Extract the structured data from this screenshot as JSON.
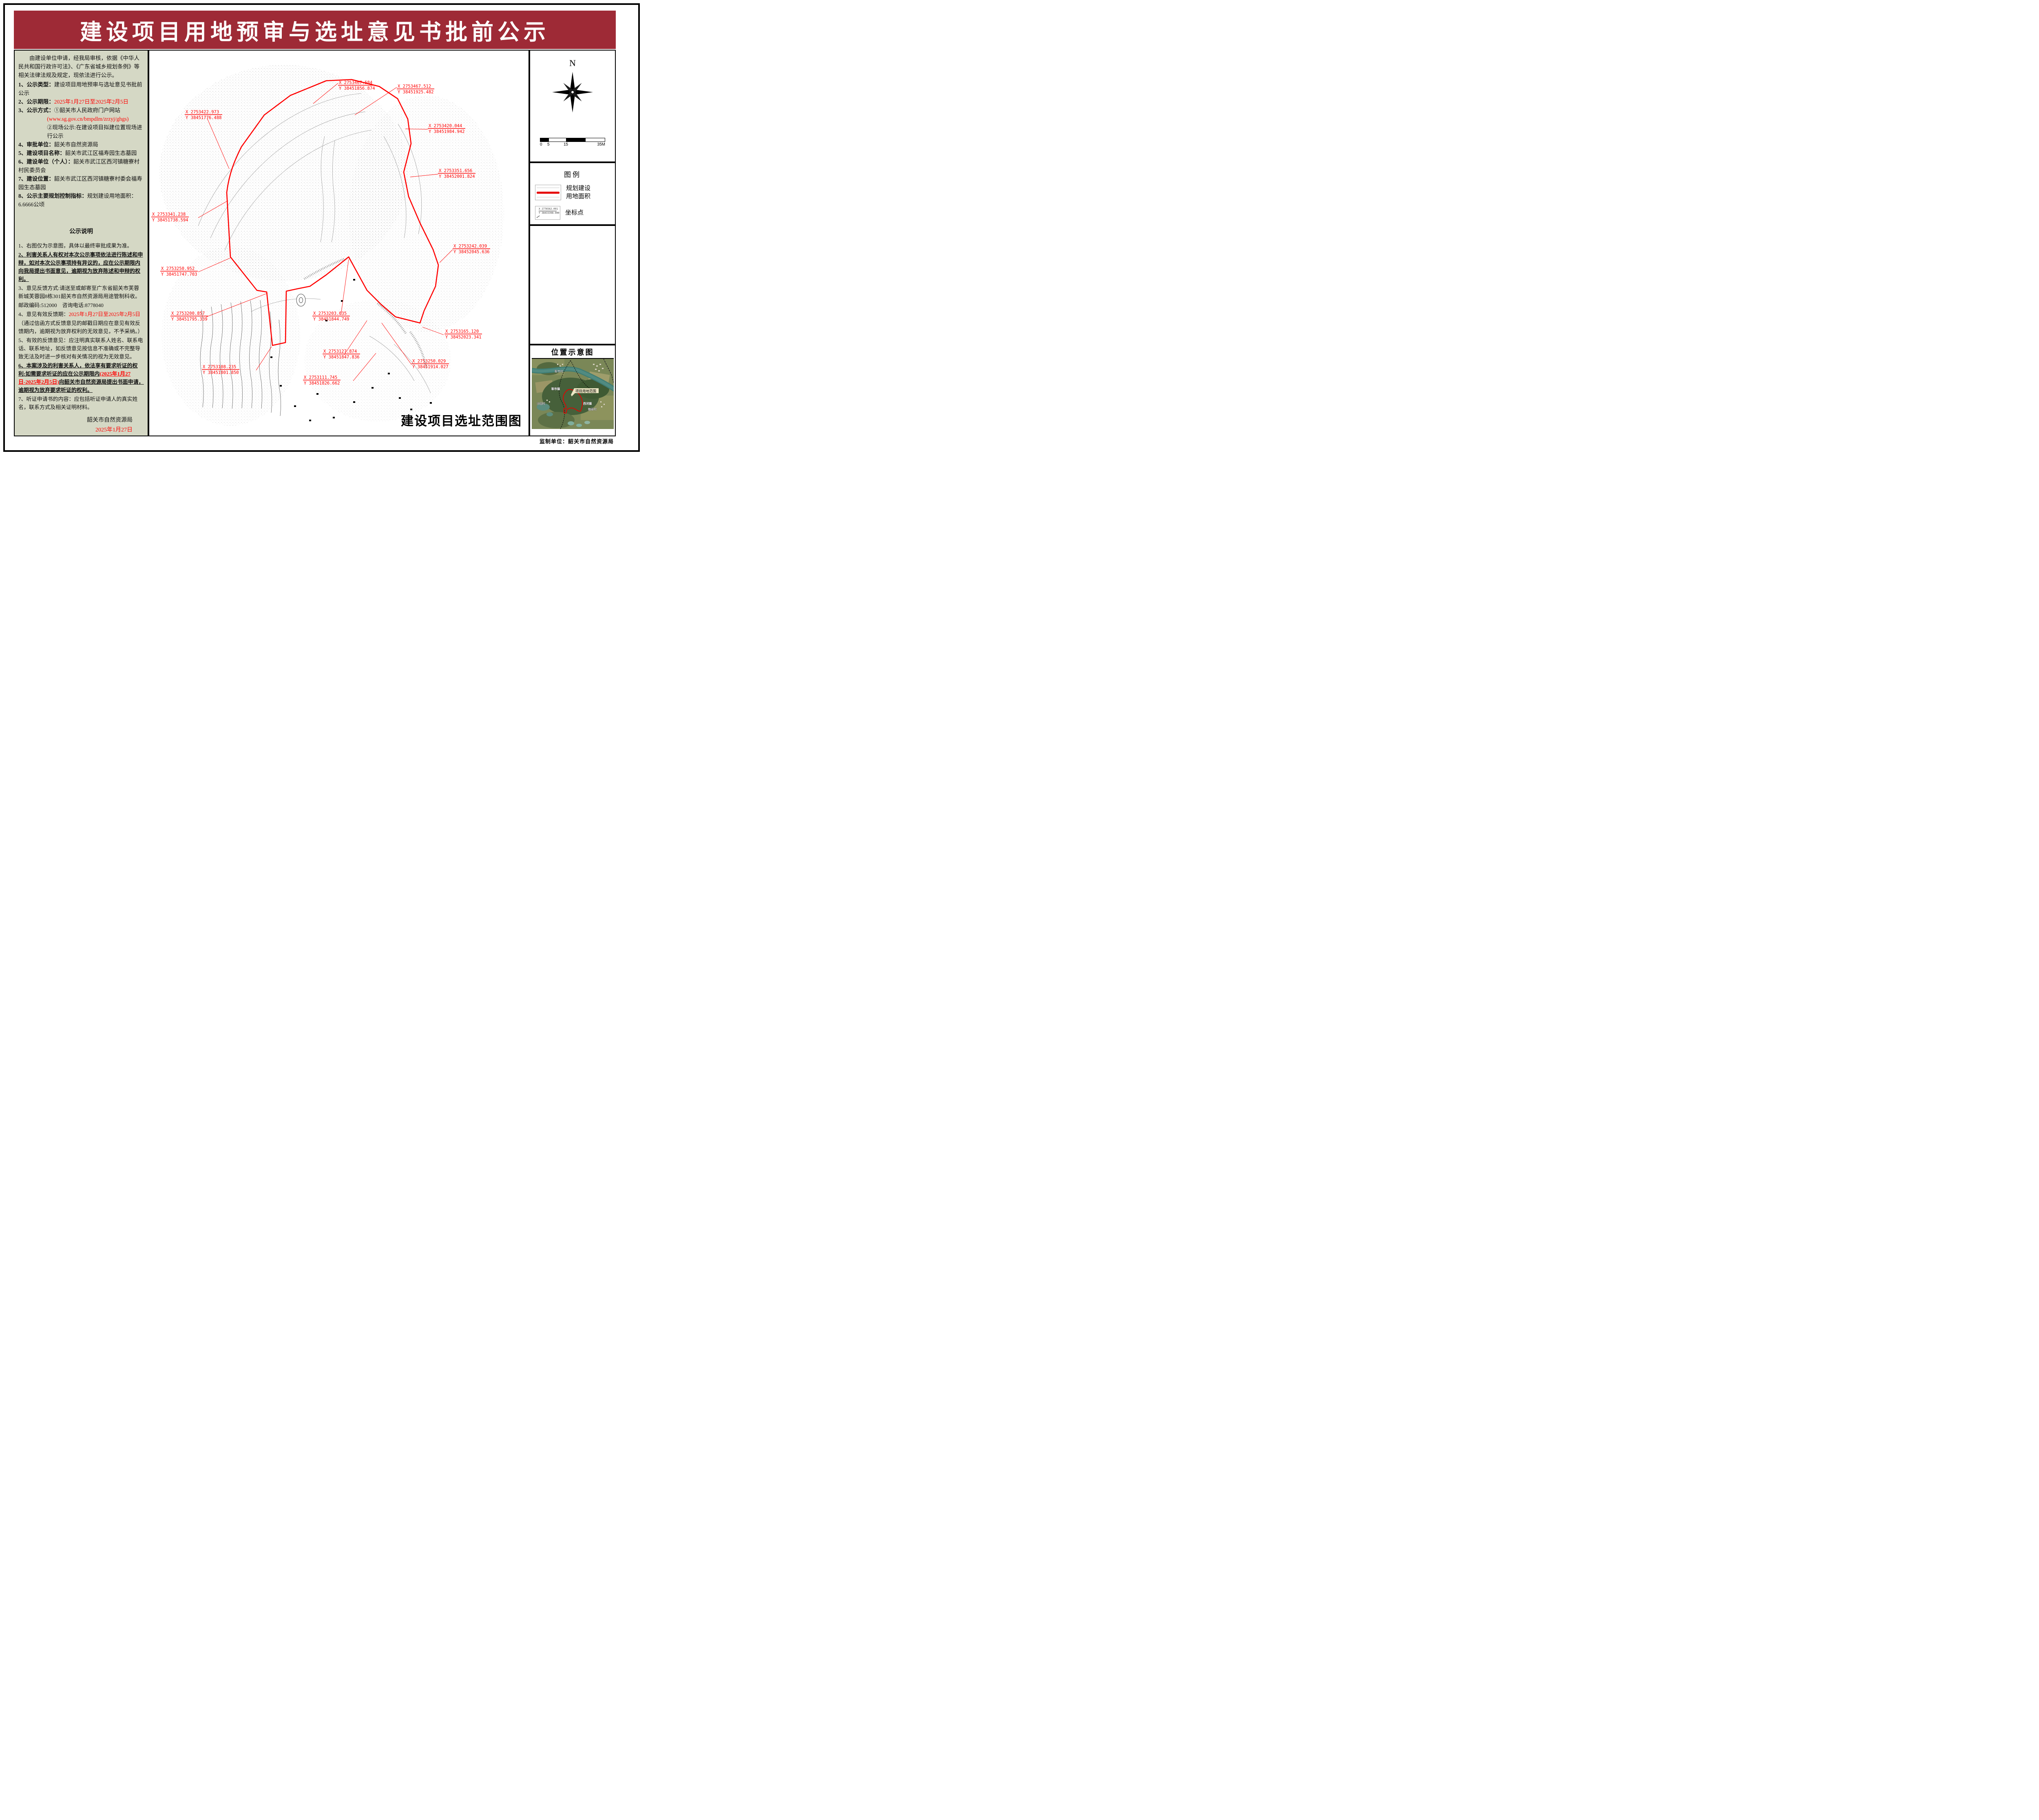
{
  "page": {
    "title": "建设项目用地预审与选址意见书批前公示",
    "colors": {
      "banner": "#9e2a36",
      "panel_bg": "#d5d8c5",
      "highlight_red": "#ff0000",
      "boundary_red": "#e60000"
    }
  },
  "left_panel": {
    "intro": "由建设单位申请，经我局审核，依据《中华人民共和国行政许可法》、《广东省城乡规划条例》等相关法律法规及规定，现依法进行公示。",
    "item1_label": "1、公示类型：",
    "item1_value": "建设项目用地预审与选址意见书批前公示",
    "item2_label": "2、公示期限：",
    "item2_value": "2025年1月27日至2025年2月5日",
    "item3_label": "3、公示方式：",
    "item3_value": "①韶关市人民政府门户网站",
    "item3_url": "(www.sg.gov.cn/bmpdlm/zrzyj/ghgs)",
    "item3_sub2": "②现场公示:在建设项目拟建位置现场进行公示",
    "item4_label": "4、审批单位：",
    "item4_value": "韶关市自然资源局",
    "item5_label": "5、建设项目名称：",
    "item5_value": "韶关市武江区福寿园生态墓园",
    "item6_label": "6、建设单位（个人）：",
    "item6_value": "韶关市武江区西河镇糖寮村村民委员会",
    "item7_label": "7、建设位置：",
    "item7_value": "韶关市武江区西河镇糖寮村委会福寿园生态墓园",
    "item8_label": "8、公示主要规划控制指标：",
    "item8_value": "规划建设用地面积：6.6666公顷",
    "notes_title": "公示说明",
    "note1": "1、右图仅为示意图，具体以最终审批成果为准。",
    "note2": "2、利害关系人有权对本次公示事项依法进行陈述和申辩，如对本次公示事项持有异议的，应在公示期限内向我局提出书面意见，逾期视为放弃陈述和申辩的权利。",
    "note3": "3、意见反馈方式:请送至或邮寄至广东省韶关市芙蓉新城芙蓉园8栋301韶关市自然资源局用途管制科收。",
    "note3b": "邮政编码:512000　咨询电话:8778040",
    "note4_label": "4、意见有效反馈期：",
    "note4_value": "2025年1月27日至2025年2月5日",
    "note4b": "（通过信函方式反馈意见的邮戳日期应在意见有效反馈期内，逾期视为放弃权利的无效意见，不予采纳。）",
    "note5": "5、有效的反馈意见：应注明真实联系人姓名、联系电话、联系地址，如反馈意见按信息不准确或不完整导致无法及时进一步核对有关情况的视为无效意见。",
    "note6_pre": "6、本案涉及的利害关系人，依法享有要求听证的权利:如需要求听证的应在公示期限内",
    "note6_red": "(2025年1月27日-2025年2月5日)",
    "note6_post": "向韶关市自然资源局提出书面申请，逾期视为放弃要求听证的权利。",
    "note7": "7、听证申请书的内容：应包括听证申请人的真实姓名，联系方式及相关证明材料。",
    "signature_org": "韶关市自然资源局",
    "signature_date": "2025年1月27日"
  },
  "map": {
    "title": "建设项目选址范围图",
    "labels": [
      {
        "x": "X 2753467.584",
        "y": "Y 38451856.874"
      },
      {
        "x": "X 2753467.512",
        "y": "Y 38451925.482"
      },
      {
        "x": "X 2753422.973",
        "y": "Y 38451776.488"
      },
      {
        "x": "X 2753420.044",
        "y": "Y 38451984.942"
      },
      {
        "x": "X 2753351.656",
        "y": "Y 38452001.824"
      },
      {
        "x": "X 2753341.238",
        "y": "Y 38451738.594"
      },
      {
        "x": "X 2753242.039",
        "y": "Y 38452045.636"
      },
      {
        "x": "X 2753250.952",
        "y": "Y 38451747.703"
      },
      {
        "x": "X 2753200.857",
        "y": "Y 38451795.339"
      },
      {
        "x": "X 2753203.035",
        "y": "Y 38451844.749"
      },
      {
        "x": "X 2753165.120",
        "y": "Y 38452023.341"
      },
      {
        "x": "X 2753127.874",
        "y": "Y 38451847.836"
      },
      {
        "x": "X 2753250.029",
        "y": "Y 38451914.027"
      },
      {
        "x": "X 2753108.235",
        "y": "Y 38451801.850"
      },
      {
        "x": "X 2753111.745",
        "y": "Y 38451826.662"
      }
    ]
  },
  "right_panel": {
    "north_label": "N",
    "scale_ticks": {
      "t0": "0",
      "t1": "5",
      "t2": "15",
      "t3": "35M"
    },
    "legend": {
      "title": "图例",
      "item1_line1": "规划建设",
      "item1_line2": "用地面积",
      "item2_label": "坐标点",
      "sample_x": "X 2776562.091",
      "sample_y": "Y 38433398.900"
    },
    "location": {
      "title": "位置示意图",
      "callout": "项目用地范围",
      "place1": "犁市村",
      "place2": "犁市镇",
      "place3": "沙园村",
      "place4": "西河镇",
      "place5": "糖寮村"
    },
    "producer": "监制单位：韶关市自然资源局"
  }
}
